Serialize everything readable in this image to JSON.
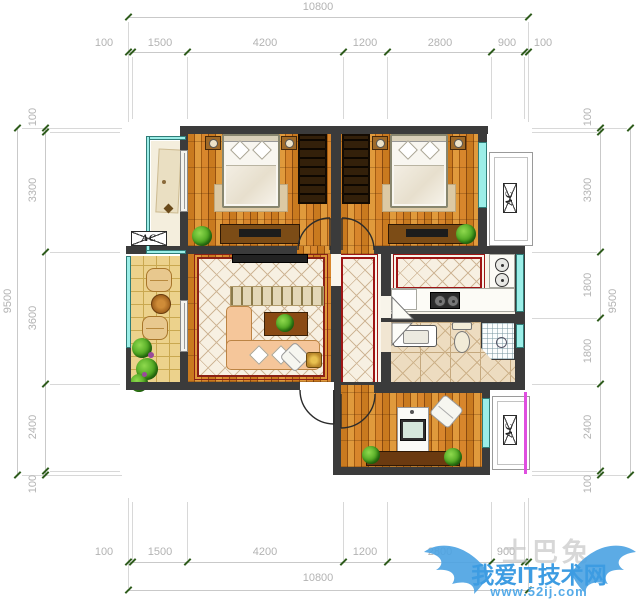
{
  "dimensions": {
    "top": {
      "total": "10800",
      "segments": [
        "100",
        "1500",
        "4200",
        "1200",
        "2800",
        "900",
        "100"
      ]
    },
    "bottom": {
      "total": "10800",
      "segments": [
        "100",
        "1500",
        "4200",
        "1200",
        "2800",
        "900"
      ]
    },
    "left": {
      "total": "9500",
      "segments": [
        "100",
        "3300",
        "3600",
        "2400",
        "100"
      ]
    },
    "right": {
      "total": "9500",
      "segments": [
        "100",
        "3300",
        "1800",
        "1800",
        "2400",
        "100"
      ]
    }
  },
  "plan": {
    "ac_label": "AC"
  },
  "watermark": {
    "brand": "土巴兔",
    "title": "我爱IT技术网",
    "url": "www.52ij.com"
  },
  "colors": {
    "wall": "#3b3b3b",
    "window": "#9ceee8",
    "rug_border": "#9e1515",
    "tick": "#2e5c1c",
    "watermark_blue": "#3d9ce2"
  }
}
